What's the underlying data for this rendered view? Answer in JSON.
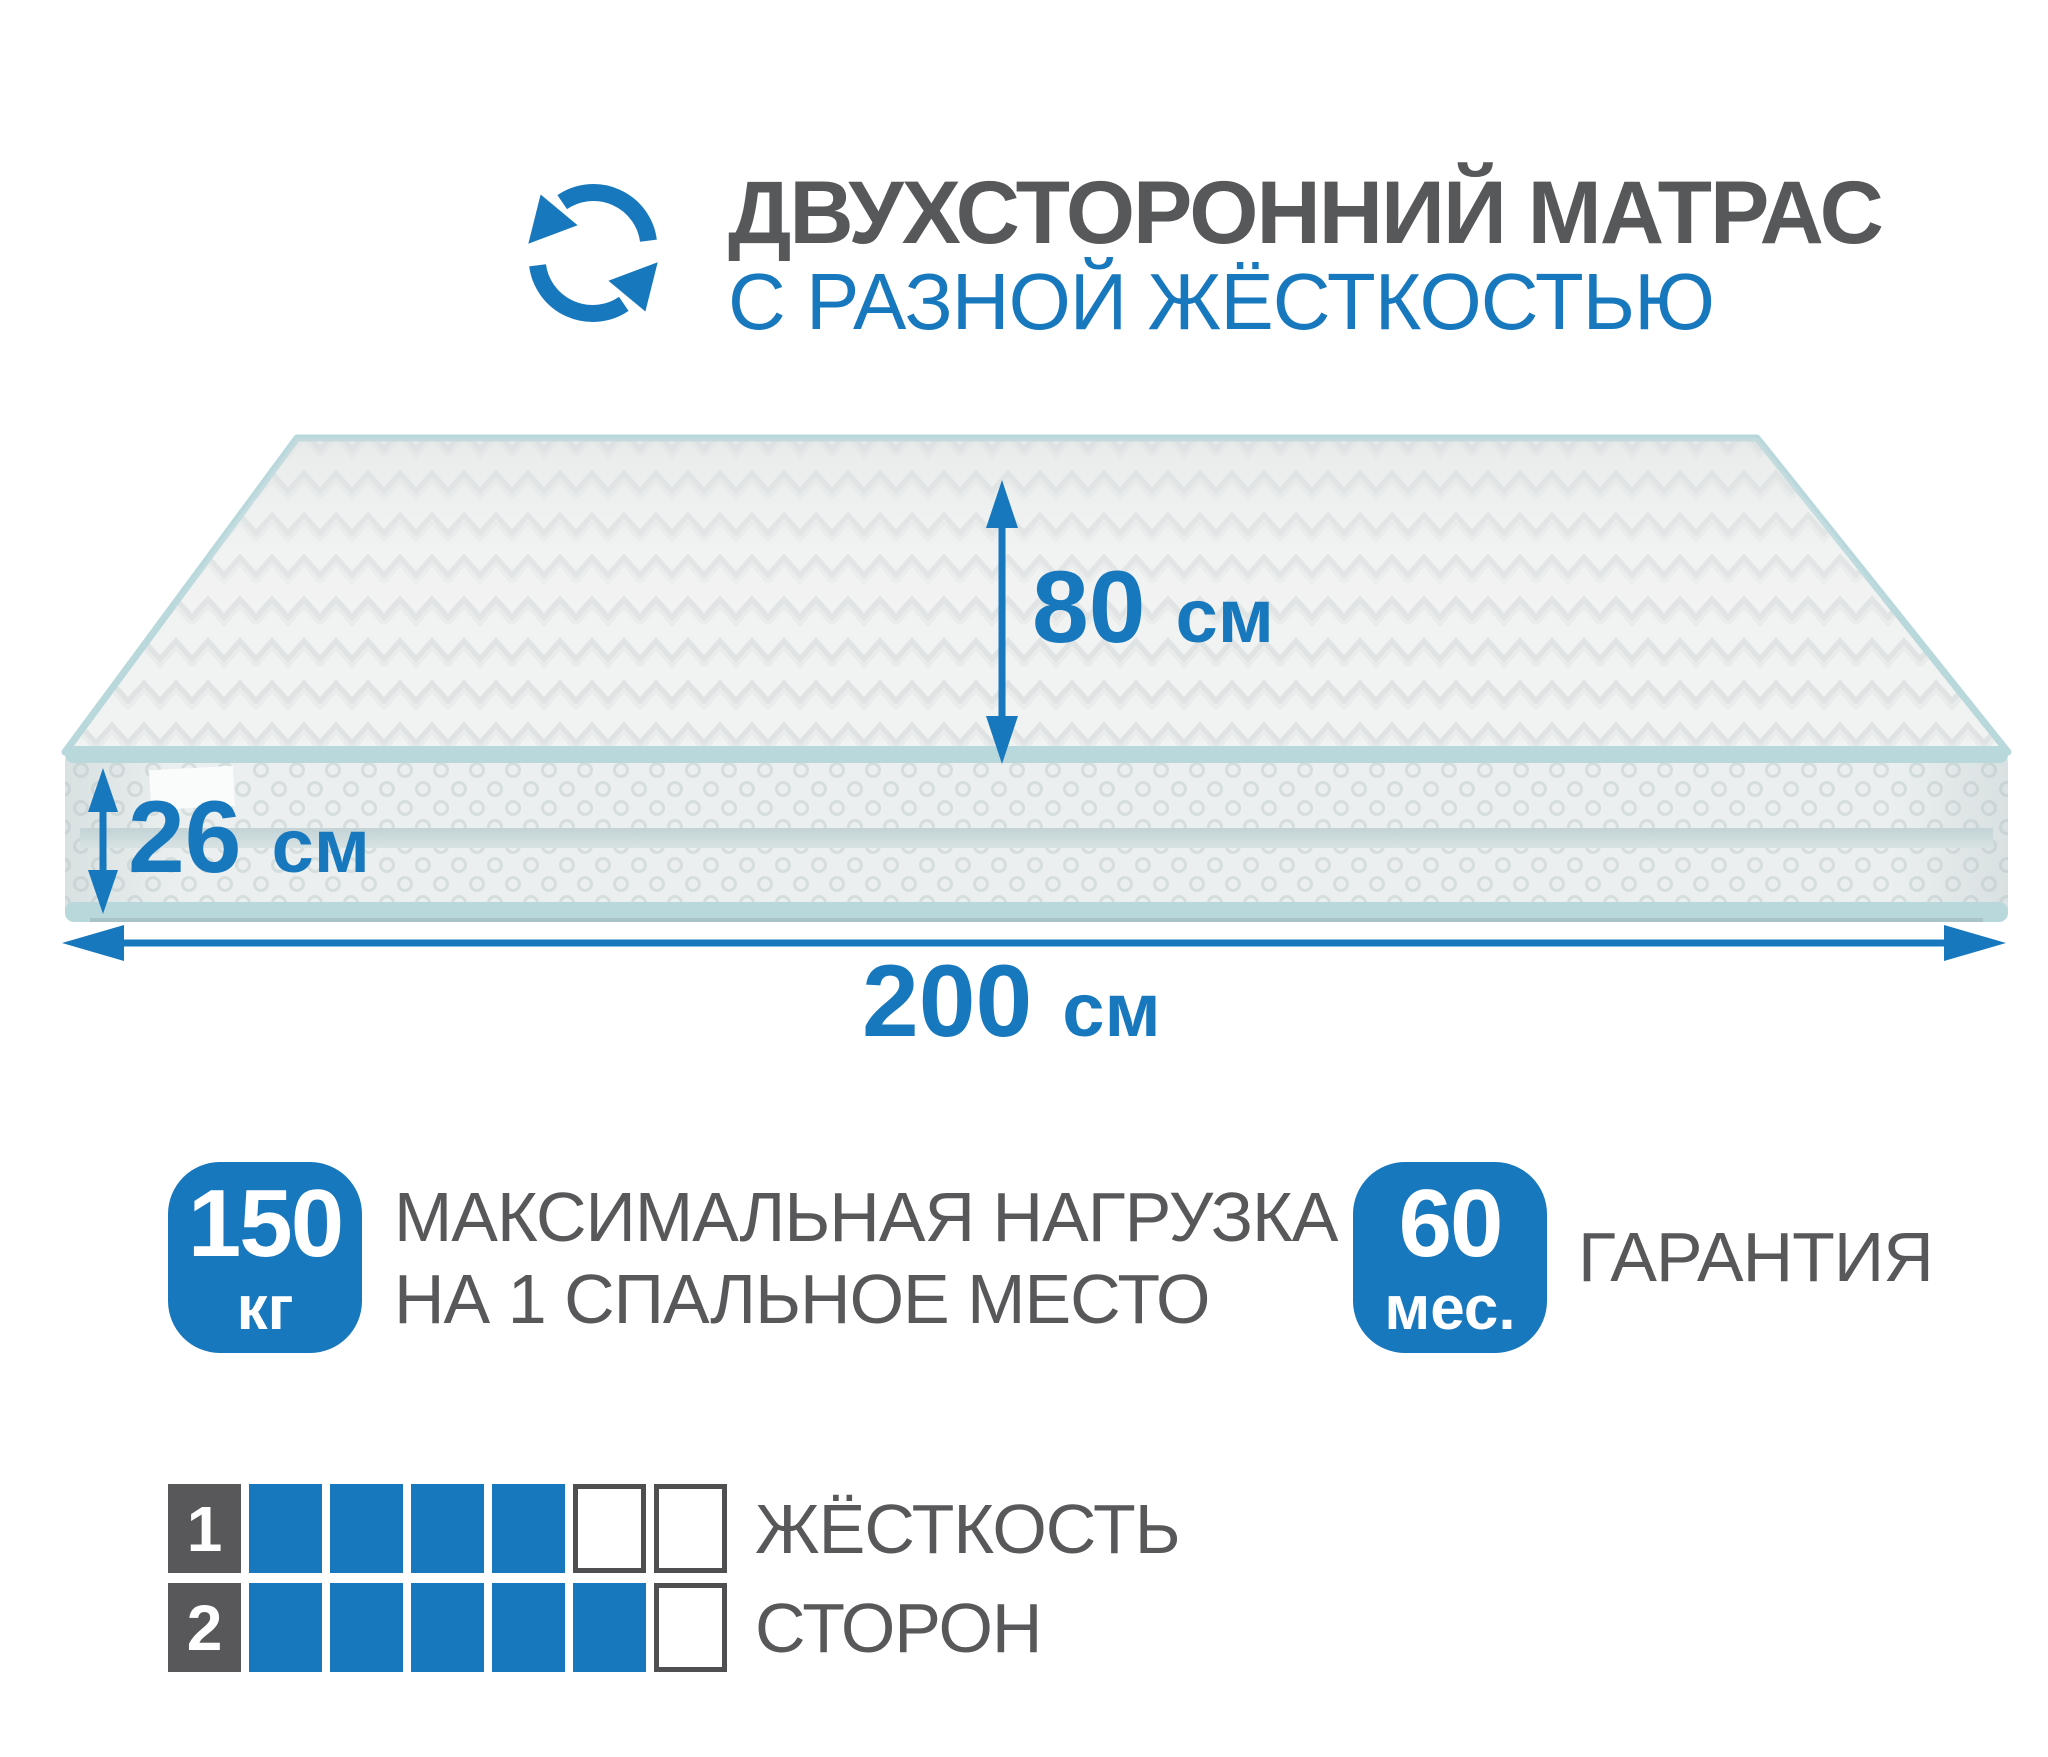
{
  "colors": {
    "accent_blue": "#1878be",
    "text_gray": "#58585a",
    "mattress_piping_mint": "#b9d8dc",
    "mattress_fabric": "#f1f2f2"
  },
  "header": {
    "icon": "rotate-arrows-icon",
    "title_line1": "ДВУХСТОРОННИЙ МАТРАС",
    "title_line2": "С РАЗНОЙ ЖЁСТКОСТЬЮ"
  },
  "dimensions": {
    "sleep_width": {
      "value": "80",
      "unit": "см"
    },
    "thickness": {
      "value": "26",
      "unit": "см"
    },
    "length": {
      "value": "200",
      "unit": "см"
    }
  },
  "load_badge": {
    "value": "150",
    "unit": "кг",
    "caption_line1": "МАКСИМАЛЬНАЯ НАГРУЗКА",
    "caption_line2": "НА 1 СПАЛЬНОЕ МЕСТО"
  },
  "warranty_badge": {
    "value": "60",
    "unit": "мес.",
    "caption": "ГАРАНТИЯ"
  },
  "firmness_scale": {
    "rows": [
      {
        "side": "1",
        "filled": 4,
        "total": 6
      },
      {
        "side": "2",
        "filled": 5,
        "total": 6
      }
    ],
    "caption_line1": "ЖЁСТКОСТЬ",
    "caption_line2": "СТОРОН"
  }
}
